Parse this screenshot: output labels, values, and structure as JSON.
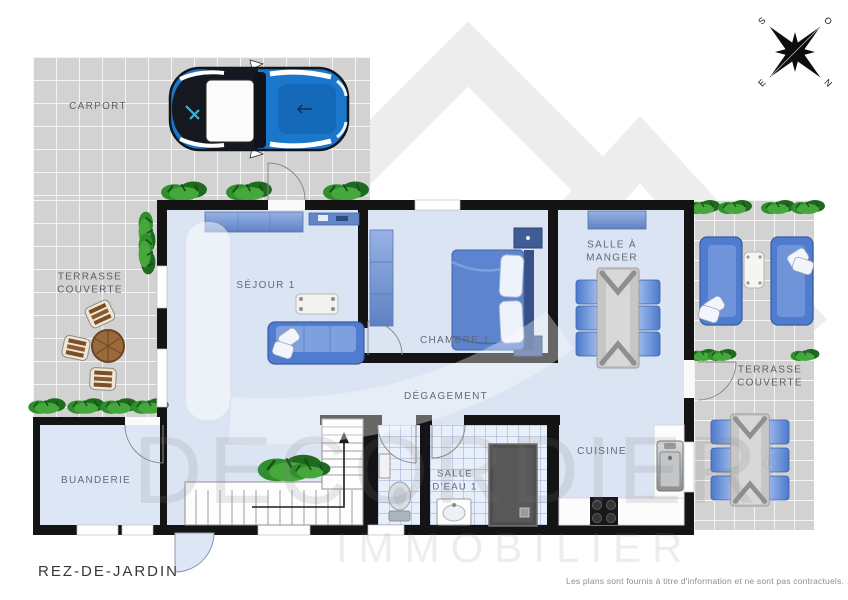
{
  "plan_title": "REZ-DE-JARDIN",
  "disclaimer": "Les plans sont fournis à titre d'information et ne sont pas contractuels.",
  "watermark": {
    "brand": "DECORDIER",
    "registered": "®",
    "brand_line2": "IMMOBILIER"
  },
  "compass": {
    "south": "S",
    "west": "O",
    "east": "E",
    "north": "N"
  },
  "rooms": {
    "carport": {
      "label": "CARPORT"
    },
    "terrasse_left": {
      "label_line1": "TERRASSE",
      "label_line2": "COUVERTE"
    },
    "sejour": {
      "label": "SÉJOUR 1"
    },
    "chambre": {
      "label": "CHAMBRE 1"
    },
    "salle_a_manger": {
      "label_line1": "SALLE À",
      "label_line2": "MANGER"
    },
    "degagement": {
      "label": "DÉGAGEMENT"
    },
    "buanderie": {
      "label": "BUANDERIE"
    },
    "salle_d_eau": {
      "label_line1": "SALLE",
      "label_line2": "D'EAU 1"
    },
    "cuisine": {
      "label": "CUISINE"
    },
    "terrasse_right": {
      "label_line1": "TERRASSE",
      "label_line2": "COUVERTE"
    }
  },
  "colors": {
    "floor": "#dbe4f3",
    "wall": "#141414",
    "outdoor_tile": "#d2d2d2",
    "accent_blue": "#4f7ccf",
    "car_blue": "#1b77cc",
    "plant_green": "#2f8f2c",
    "shower_gray": "#4e4e4e"
  }
}
